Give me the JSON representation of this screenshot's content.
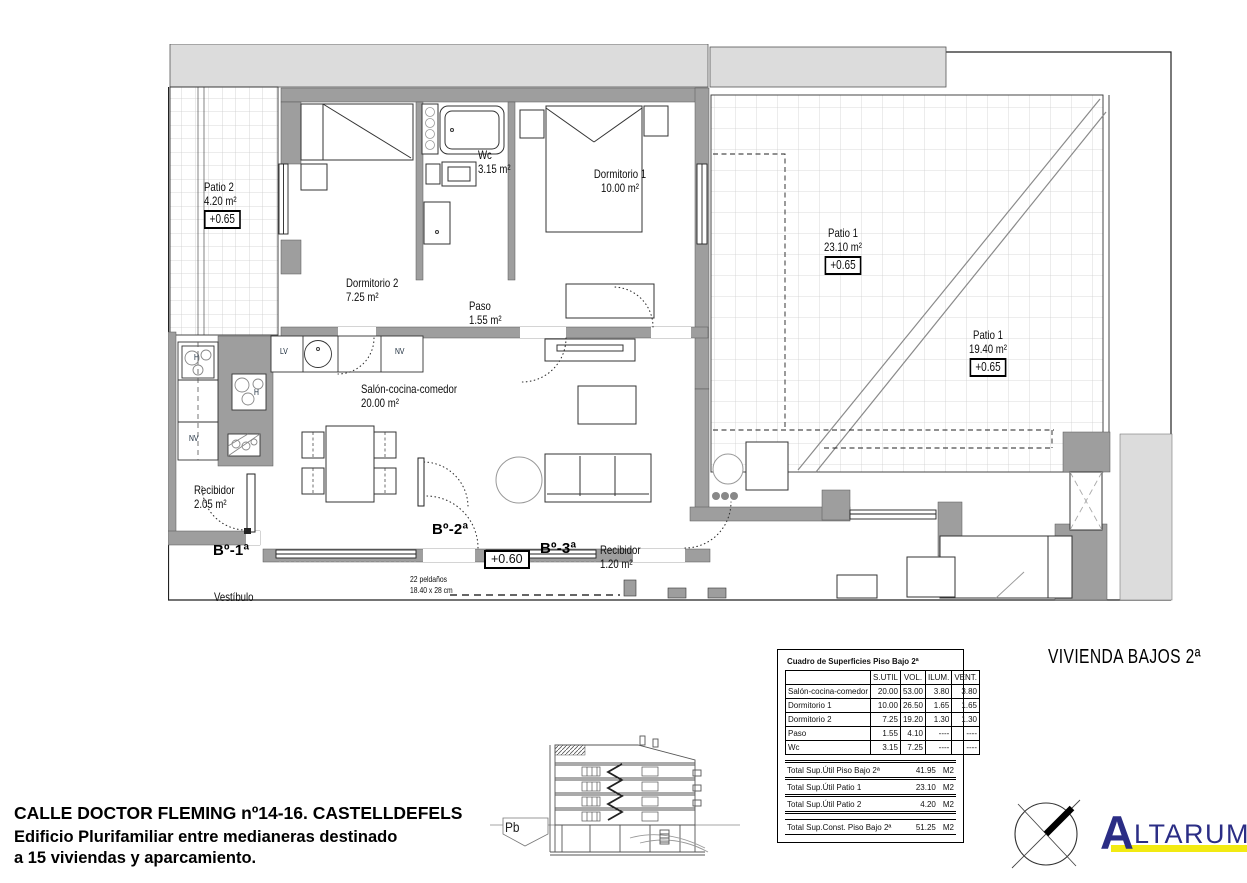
{
  "plan": {
    "labels": {
      "patio2": {
        "name": "Patio 2",
        "area": "4.20 m²",
        "level": "+0.65"
      },
      "wc": {
        "name": "Wc",
        "area": "3.15 m²"
      },
      "dorm1": {
        "name": "Dormitorio 1",
        "area": "10.00 m²"
      },
      "dorm2": {
        "name": "Dormitorio 2",
        "area": "7.25 m²"
      },
      "paso": {
        "name": "Paso",
        "area": "1.55 m²"
      },
      "salon": {
        "name": "Salón-cocina-comedor",
        "area": "20.00 m²"
      },
      "patio1a": {
        "name": "Patio 1",
        "area": "23.10 m²",
        "level": "+0.65"
      },
      "patio1b": {
        "name": "Patio 1",
        "area": "19.40 m²",
        "level": "+0.65"
      },
      "recibidor1": {
        "name": "Recibidor",
        "area": "2.05 m²"
      },
      "recibidor2": {
        "name": "Recibidor",
        "area": "1.20 m²"
      },
      "vestibulo": {
        "name": "Vestíbulo"
      },
      "door1": "Bº-1ª",
      "door2": "Bº-2ª",
      "door3": "Bº-3ª",
      "level_entry": "+0.60",
      "stairs_line1": "22 peldaños",
      "stairs_line2": "18.40 x 28 cm",
      "lv": "LV",
      "nv": "NV",
      "h": "H"
    },
    "colors": {
      "wall_gray": "#9e9e9e",
      "light_gray": "#dcdcdc"
    }
  },
  "table": {
    "title": "Cuadro de Superficies Piso Bajo 2ª",
    "columns": [
      "",
      "S.UTIL",
      "VOL.",
      "ILUM.",
      "VENT."
    ],
    "rows": [
      [
        "Salón-cocina-comedor",
        "20.00",
        "53.00",
        "3.80",
        "3.80"
      ],
      [
        "Dormitorio 1",
        "10.00",
        "26.50",
        "1.65",
        "1.65"
      ],
      [
        "Dormitorio 2",
        "7.25",
        "19.20",
        "1.30",
        "1.30"
      ],
      [
        "Paso",
        "1.55",
        "4.10",
        "----",
        "----"
      ],
      [
        "Wc",
        "3.15",
        "7.25",
        "----",
        "----"
      ]
    ],
    "totals": [
      {
        "label": "Total Sup.Útil Piso Bajo 2ª",
        "value": "41.95",
        "unit": "M2"
      },
      {
        "label": "Total Sup.Útil Patio 1",
        "value": "23.10",
        "unit": "M2"
      },
      {
        "label": "Total Sup.Útil Patio 2",
        "value": "4.20",
        "unit": "M2"
      }
    ],
    "grand_total": {
      "label": "Total Sup.Const. Piso Bajo 2ª",
      "value": "51.25",
      "unit": "M2"
    }
  },
  "titles": {
    "sheet_title": "VIVIENDA BAJOS 2ª"
  },
  "address": {
    "line1": "CALLE DOCTOR FLEMING nº14-16. CASTELLDEFELS",
    "line2": "Edificio Plurifamiliar entre medianeras destinado",
    "line3": "a 15 viviendas y aparcamiento."
  },
  "section": {
    "label": "Pb"
  },
  "logo": {
    "name_initial": "A",
    "name_rest": "LTARUM",
    "suffix": "S.L.",
    "blue": "#2b2d85",
    "yellow": "#f2ea12"
  }
}
